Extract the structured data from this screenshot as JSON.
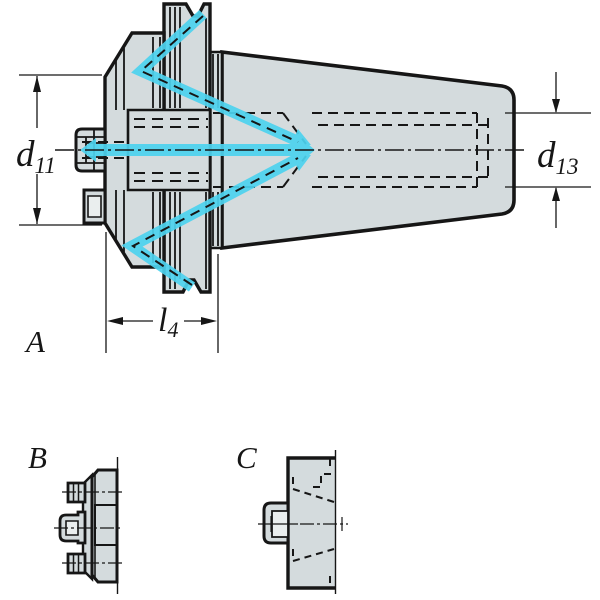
{
  "colors": {
    "line": "#161616",
    "body_fill": "#d4dbdd",
    "detail_fill": "#eaeeee",
    "coolant": "#4dd3ef",
    "background": "#ffffff"
  },
  "views": {
    "main": {
      "label": "A"
    },
    "flange_side": {
      "label": "B"
    },
    "rear": {
      "label": "C"
    }
  },
  "dimensions": {
    "d11": {
      "base": "d",
      "sub": "11"
    },
    "d13": {
      "base": "d",
      "sub": "13"
    },
    "l4": {
      "base": "l",
      "sub": "4"
    }
  }
}
